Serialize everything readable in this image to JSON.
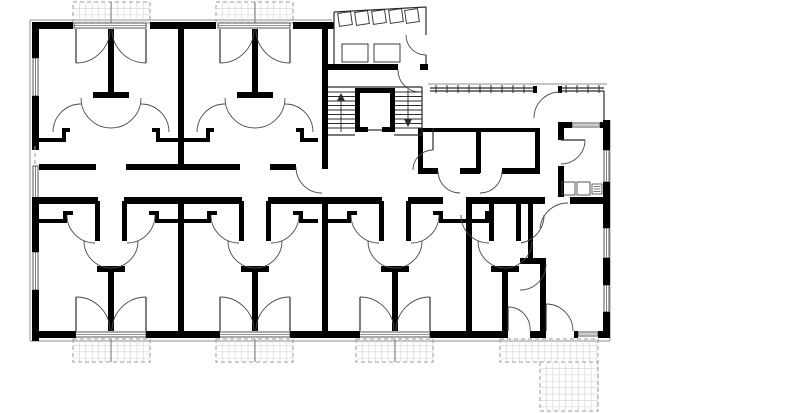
{
  "meta": {
    "title": "Residential building floor plan",
    "drawing_type": "architectural-floor-plan",
    "visible_text": []
  },
  "canvas": {
    "w": 800,
    "h": 413,
    "bg": "#ffffff"
  },
  "styles": {
    "wall": "#000000",
    "thin": "#2b2b2b",
    "arc": "#4a4a4a",
    "gray": "#b3b3b3",
    "grid": "#d9d9d9",
    "dash": "#9a9a9a",
    "fixture": "#444444",
    "white": "#ffffff"
  },
  "gray_lines": [
    [
      30,
      20,
      30,
      341
    ],
    [
      30,
      20,
      332,
      20
    ],
    [
      30,
      341,
      610,
      341
    ],
    [
      610,
      120,
      610,
      341
    ],
    [
      428,
      84,
      607,
      84
    ]
  ],
  "walls": [
    [
      32,
      22,
      7,
      36
    ],
    [
      32,
      96,
      7,
      54
    ],
    [
      32,
      198,
      7,
      54
    ],
    [
      32,
      290,
      7,
      51
    ],
    [
      32,
      22,
      41,
      7
    ],
    [
      150,
      22,
      66,
      7
    ],
    [
      293,
      22,
      41,
      7
    ],
    [
      32,
      331,
      44,
      7
    ],
    [
      146,
      331,
      74,
      7
    ],
    [
      290,
      331,
      70,
      7
    ],
    [
      430,
      331,
      78,
      7
    ],
    [
      530,
      331,
      16,
      7
    ],
    [
      574,
      331,
      4,
      7
    ],
    [
      598,
      331,
      12,
      7
    ],
    [
      603,
      120,
      7,
      30
    ],
    [
      603,
      182,
      7,
      46
    ],
    [
      603,
      258,
      7,
      27
    ],
    [
      603,
      312,
      7,
      26
    ],
    [
      322,
      22,
      6,
      147
    ],
    [
      328,
      64,
      70,
      6
    ],
    [
      420,
      64,
      8,
      6
    ],
    [
      39,
      164,
      57,
      6
    ],
    [
      126,
      164,
      56,
      6
    ],
    [
      182,
      164,
      58,
      6
    ],
    [
      270,
      164,
      26,
      6
    ],
    [
      418,
      128,
      122,
      4
    ],
    [
      418,
      128,
      5,
      45
    ],
    [
      476,
      128,
      5,
      45
    ],
    [
      535,
      128,
      5,
      45
    ],
    [
      418,
      168,
      20,
      6
    ],
    [
      460,
      168,
      20,
      6
    ],
    [
      502,
      168,
      38,
      6
    ],
    [
      32,
      197,
      66,
      7
    ],
    [
      124,
      197,
      118,
      7
    ],
    [
      268,
      197,
      114,
      7
    ],
    [
      408,
      197,
      35,
      7
    ],
    [
      472,
      197,
      73,
      7
    ],
    [
      570,
      197,
      33,
      7
    ],
    [
      178,
      197,
      6,
      141
    ],
    [
      322,
      197,
      6,
      141
    ],
    [
      466,
      197,
      6,
      141
    ],
    [
      178,
      29,
      6,
      135
    ],
    [
      108,
      29,
      6,
      63
    ],
    [
      93,
      92,
      36,
      6
    ],
    [
      39,
      138,
      23,
      4
    ],
    [
      62,
      130,
      4,
      12
    ],
    [
      62,
      128,
      8,
      4
    ],
    [
      160,
      138,
      18,
      4
    ],
    [
      156,
      130,
      4,
      12
    ],
    [
      152,
      128,
      8,
      4
    ],
    [
      252,
      29,
      6,
      63
    ],
    [
      237,
      92,
      36,
      6
    ],
    [
      184,
      138,
      22,
      4
    ],
    [
      206,
      130,
      4,
      12
    ],
    [
      206,
      128,
      8,
      4
    ],
    [
      304,
      138,
      14,
      4
    ],
    [
      300,
      130,
      4,
      12
    ],
    [
      296,
      128,
      8,
      4
    ],
    [
      95,
      201,
      5,
      40
    ],
    [
      122,
      201,
      5,
      40
    ],
    [
      39,
      219,
      24,
      4
    ],
    [
      63,
      211,
      4,
      12
    ],
    [
      63,
      211,
      10,
      4
    ],
    [
      149,
      211,
      10,
      4
    ],
    [
      155,
      211,
      4,
      12
    ],
    [
      159,
      219,
      19,
      4
    ],
    [
      97,
      266,
      28,
      6
    ],
    [
      108,
      272,
      6,
      59
    ],
    [
      239,
      201,
      5,
      40
    ],
    [
      266,
      201,
      5,
      40
    ],
    [
      184,
      219,
      23,
      4
    ],
    [
      207,
      211,
      4,
      12
    ],
    [
      207,
      211,
      10,
      4
    ],
    [
      293,
      211,
      10,
      4
    ],
    [
      299,
      211,
      4,
      12
    ],
    [
      303,
      219,
      15,
      4
    ],
    [
      241,
      266,
      28,
      6
    ],
    [
      252,
      272,
      6,
      59
    ],
    [
      379,
      201,
      5,
      40
    ],
    [
      406,
      201,
      5,
      40
    ],
    [
      327,
      219,
      20,
      4
    ],
    [
      347,
      211,
      4,
      12
    ],
    [
      347,
      211,
      10,
      4
    ],
    [
      433,
      211,
      10,
      4
    ],
    [
      439,
      211,
      4,
      12
    ],
    [
      443,
      219,
      23,
      4
    ],
    [
      381,
      266,
      28,
      6
    ],
    [
      392,
      272,
      6,
      59
    ],
    [
      489,
      201,
      5,
      40
    ],
    [
      516,
      201,
      5,
      40
    ],
    [
      472,
      219,
      13,
      4
    ],
    [
      485,
      211,
      4,
      12
    ],
    [
      491,
      266,
      28,
      6
    ],
    [
      502,
      272,
      6,
      59
    ],
    [
      558,
      122,
      14,
      6
    ],
    [
      600,
      122,
      4,
      6
    ],
    [
      558,
      122,
      6,
      18
    ],
    [
      558,
      166,
      6,
      31
    ],
    [
      528,
      204,
      5,
      57
    ],
    [
      520,
      258,
      26,
      6
    ],
    [
      540,
      264,
      6,
      67
    ],
    [
      355,
      88,
      40,
      5
    ],
    [
      355,
      88,
      5,
      44
    ],
    [
      390,
      88,
      5,
      44
    ],
    [
      355,
      127,
      13,
      5
    ],
    [
      382,
      127,
      13,
      5
    ],
    [
      533,
      86,
      4,
      7
    ],
    [
      558,
      86,
      4,
      7
    ]
  ],
  "thin_lines": [
    [
      334,
      64,
      334,
      12
    ],
    [
      334,
      12,
      426,
      7
    ],
    [
      426,
      7,
      426,
      35
    ],
    [
      426,
      55,
      426,
      64
    ],
    [
      367,
      130,
      382,
      130
    ],
    [
      328,
      87,
      422,
      87
    ],
    [
      422,
      87,
      422,
      135
    ],
    [
      328,
      135,
      355,
      135
    ],
    [
      394,
      135,
      422,
      135
    ],
    [
      430,
      88,
      533,
      88
    ],
    [
      430,
      91,
      533,
      91
    ],
    [
      562,
      88,
      604,
      88
    ],
    [
      562,
      91,
      604,
      91
    ],
    [
      604,
      91,
      604,
      120
    ],
    [
      433,
      128,
      433,
      150
    ],
    [
      76,
      29,
      76,
      63
    ],
    [
      146,
      29,
      146,
      63
    ],
    [
      220,
      29,
      220,
      63
    ],
    [
      290,
      29,
      290,
      63
    ],
    [
      76,
      297,
      76,
      331
    ],
    [
      146,
      297,
      146,
      331
    ],
    [
      220,
      297,
      220,
      331
    ],
    [
      290,
      297,
      290,
      331
    ],
    [
      360,
      297,
      360,
      331
    ],
    [
      430,
      297,
      430,
      331
    ],
    [
      508,
      307,
      508,
      331
    ],
    [
      546,
      304,
      546,
      331
    ],
    [
      561,
      140,
      585,
      140
    ]
  ],
  "dashed_lines": [
    [
      35,
      146,
      35,
      166
    ]
  ],
  "railing_ticks": {
    "y1": 85,
    "y2": 93,
    "xs": [
      436,
      447,
      458,
      469,
      480,
      491,
      502,
      513,
      524,
      566,
      577,
      588,
      599
    ]
  },
  "arcs": [
    "M76,63 A34,34 0 0 0 110,29",
    "M146,63 A34,34 0 0 1 112,29",
    "M220,63 A34,34 0 0 0 254,29",
    "M290,63 A34,34 0 0 1 256,29",
    "M81,98 A30,30 0 0 0 141,98",
    "M53,132 A28,28 0 0 1 81,104",
    "M169,132 A28,28 0 0 0 141,104",
    "M225,98 A30,30 0 0 0 285,98",
    "M197,132 A28,28 0 0 1 225,104",
    "M313,132 A28,28 0 0 0 285,104",
    "M84,241 A27,27 0 0 0 138,241",
    "M67,215 A28,28 0 0 0 95,243",
    "M155,215 A28,28 0 0 1 127,243",
    "M228,241 A27,27 0 0 0 282,241",
    "M211,215 A28,28 0 0 0 239,243",
    "M299,215 A28,28 0 0 1 271,243",
    "M368,241 A27,27 0 0 0 422,241",
    "M351,215 A28,28 0 0 0 379,243",
    "M439,215 A28,28 0 0 1 411,243",
    "M478,241 A27,27 0 0 0 532,241",
    "M461,215 A28,28 0 0 0 489,243",
    "M544,215 A28,28 0 0 1 521,243",
    "M76,297 A34,34 0 0 1 110,331",
    "M146,297 A34,34 0 0 0 112,331",
    "M220,297 A34,34 0 0 1 254,331",
    "M290,297 A34,34 0 0 0 256,331",
    "M360,297 A34,34 0 0 1 394,331",
    "M430,297 A34,34 0 0 0 396,331",
    "M508,307 A22,22 0 0 1 530,331",
    "M546,304 A27,27 0 0 1 573,331",
    "M585,140 A24,24 0 0 1 561,164",
    "M540,228 A28,28 0 0 1 568,203",
    "M546,264 A26,26 0 0 1 520,290",
    "M406,35 A20,20 0 0 0 426,55",
    "M398,70 A22,22 0 0 0 420,92",
    "M534,118 A26,26 0 0 1 560,92",
    "M296,167 A26,26 0 0 0 322,193",
    "M438,171 A22,22 0 0 0 460,193",
    "M502,171 A22,22 0 0 1 480,193",
    "M413,170 A20,20 0 0 1 433,150"
  ],
  "windows": [
    [
      33,
      58,
      5,
      38
    ],
    [
      33,
      166,
      5,
      32
    ],
    [
      33,
      252,
      5,
      38
    ],
    [
      604,
      150,
      5,
      32
    ],
    [
      604,
      228,
      5,
      30
    ],
    [
      604,
      285,
      5,
      27
    ],
    [
      572,
      123,
      28,
      4
    ],
    [
      578,
      332,
      20,
      4
    ],
    [
      74,
      23,
      72,
      5
    ],
    [
      218,
      23,
      72,
      5
    ],
    [
      74,
      332,
      72,
      5
    ],
    [
      218,
      332,
      72,
      5
    ],
    [
      358,
      332,
      72,
      5
    ]
  ],
  "balconies": [
    {
      "x": 73,
      "y": 2,
      "w": 77,
      "h": 21,
      "div": 111
    },
    {
      "x": 216,
      "y": 2,
      "w": 77,
      "h": 21,
      "div": 255
    },
    {
      "x": 73,
      "y": 339,
      "w": 77,
      "h": 23,
      "div": 111
    },
    {
      "x": 216,
      "y": 339,
      "w": 77,
      "h": 23,
      "div": 255
    },
    {
      "x": 356,
      "y": 339,
      "w": 77,
      "h": 23,
      "div": 395
    },
    {
      "x": 500,
      "y": 339,
      "w": 98,
      "h": 23,
      "div": null
    },
    {
      "x": 540,
      "y": 362,
      "w": 58,
      "h": 49,
      "div": null
    }
  ],
  "grid_cell": 6.4,
  "stairs": {
    "flights": [
      {
        "x1": 328,
        "x2": 355,
        "y_start": 92,
        "y_end": 132,
        "step": 4.5
      },
      {
        "x1": 395,
        "x2": 422,
        "y_start": 92,
        "y_end": 132,
        "step": 4.5
      }
    ],
    "arrows": [
      {
        "line": [
          341,
          95,
          341,
          132
        ],
        "tri": [
          [
            337,
            101
          ],
          [
            345,
            101
          ],
          [
            341,
            93
          ]
        ]
      },
      {
        "line": [
          408,
          90,
          408,
          125
        ],
        "tri": [
          [
            404,
            119
          ],
          [
            412,
            119
          ],
          [
            408,
            127
          ]
        ]
      }
    ]
  },
  "bike_racks": [
    {
      "cx": 345,
      "cy": 19,
      "s": 13,
      "rot": -8
    },
    {
      "cx": 362,
      "cy": 18,
      "s": 13,
      "rot": -8
    },
    {
      "cx": 379,
      "cy": 17,
      "s": 13,
      "rot": -8
    },
    {
      "cx": 396,
      "cy": 16,
      "s": 13,
      "rot": -8
    },
    {
      "cx": 412,
      "cy": 16,
      "s": 13,
      "rot": -8
    }
  ],
  "vestibule_benches": [
    [
      342,
      44,
      26,
      18
    ],
    [
      374,
      44,
      26,
      18
    ]
  ],
  "fixtures": {
    "squares": [
      [
        562,
        182,
        13,
        13
      ],
      [
        577,
        182,
        13,
        13
      ]
    ],
    "grill": {
      "x": 592,
      "y": 184,
      "w": 10,
      "h": 10,
      "lines": 3
    }
  }
}
